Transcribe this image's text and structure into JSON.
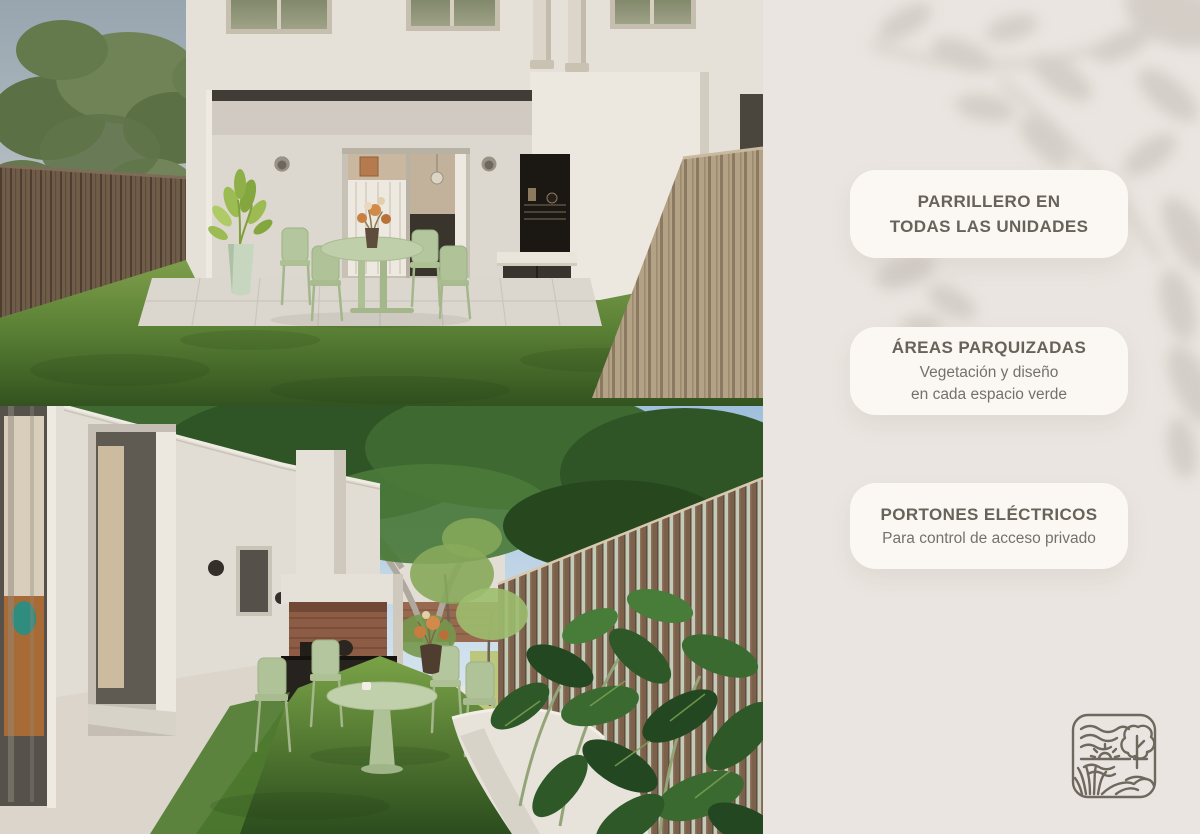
{
  "poster": {
    "background_color": "#EAE5E0",
    "leaf_shadow_color": "#C6BFB8",
    "card_background": "#FBF8F3",
    "title_color": "#67635A",
    "body_color": "#75716A"
  },
  "feature_cards": [
    {
      "title": "PARRILLERO EN\nTODAS LAS UNIDADES",
      "subtitle": ""
    },
    {
      "title": "ÁREAS PARQUIZADAS",
      "subtitle": "Vegetación y diseño\nen cada espacio verde"
    },
    {
      "title": "PORTONES ELÉCTRICOS",
      "subtitle": "Para control de acceso privado"
    }
  ],
  "logo": {
    "stroke_color": "#6F685E"
  },
  "palette": {
    "sage_furniture": "#B7C8A2",
    "lawn_green": "#5F8A3A",
    "wood_fence_dark": "#6F5C49",
    "wood_fence_light": "#B4A287",
    "wall_cream": "#E6E1D8",
    "brick": "#8D5C45"
  }
}
